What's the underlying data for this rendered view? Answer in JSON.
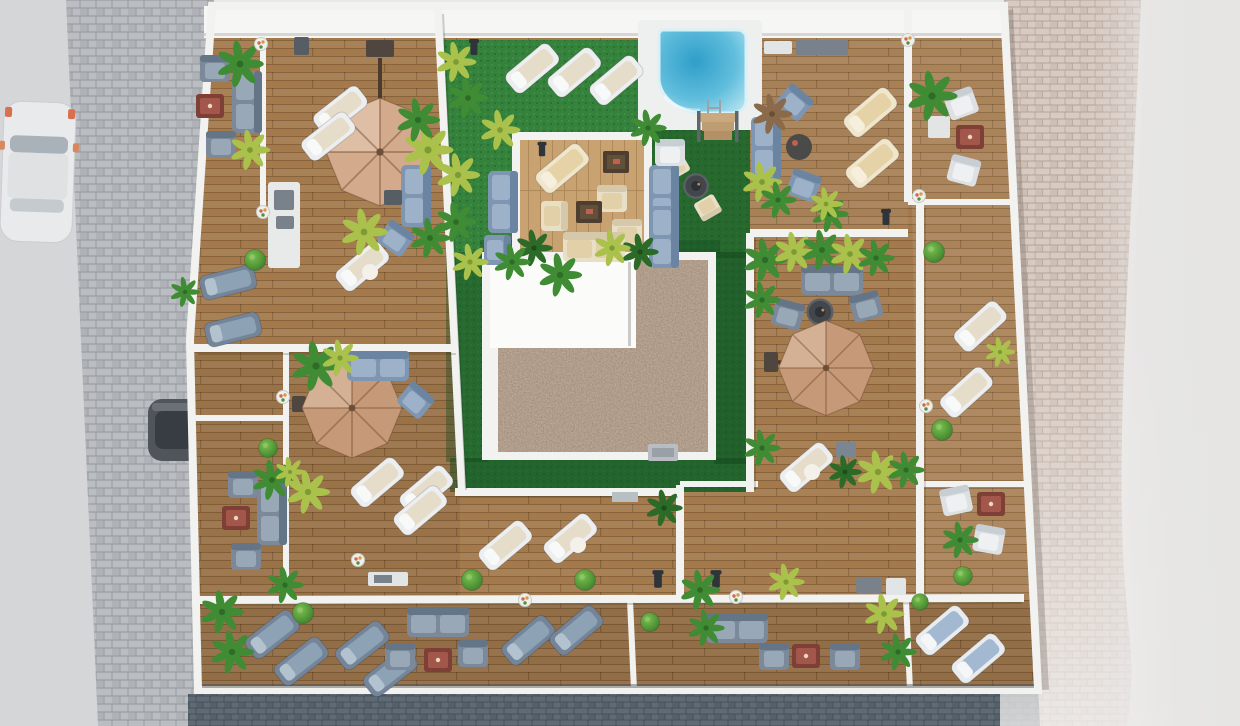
{
  "scene": {
    "title": "Aerial 3D architectural render of a rooftop terrace level",
    "type": "architectural-visualization",
    "view": "top-down aerial",
    "no_visible_text": true,
    "areas": [
      {
        "name": "street-west",
        "features": [
          "light asphalt road",
          "parked white car",
          "cobblestone sidewalk strip",
          "parked dark car half hidden by building"
        ]
      },
      {
        "name": "pavement-east",
        "features": [
          "pink cobblestone pavement fading to plain concrete at right edge",
          "curved white curb at south-east corner"
        ]
      },
      {
        "name": "street-south",
        "features": [
          "dark blue-grey cobblestone roadway"
        ]
      },
      {
        "name": "communal-courtyard",
        "features": [
          "artificial lawn",
          "swimming pool with curved corner, ladder and timber steps",
          "raised timber sun platform with beige lounge furniture",
          "three white sun loungers",
          "round fire table with chairs",
          "blue-grey outdoor sofas",
          "tropical planting"
        ]
      },
      {
        "name": "central-roof-core",
        "features": [
          "white flat roof",
          "L-shaped brown gravel roof",
          "rooftop AC unit",
          "cast shadow on lawn"
        ]
      },
      {
        "name": "private-terraces",
        "features": [
          "timber decking",
          "three tan cantilever parasols",
          "white and grey sun loungers",
          "grey outdoor sofa sets with terracotta coffee tables",
          "outdoor kitchen counters",
          "white parapet dividing walls",
          "topiary balls, palms and yellow-green shrubs",
          "planters with flowers",
          "black bollard lights"
        ]
      }
    ],
    "counts": {
      "parasols": 3,
      "swimming_pools": 1,
      "cars": 2,
      "fire_tables": 2
    }
  },
  "colors": {
    "bg": "#e8e8e7",
    "road": "#d5d6d8",
    "plain_right": "#e6e5e4",
    "cobble_l": "#babdc1",
    "cobble_l2": "#afb3b7",
    "cobble_l_joint": "#9fa3a8",
    "cobble_pink": "#d7cac2",
    "cobble_pink2": "#cebfb5",
    "cobble_pink_joint": "#bcab9f",
    "cobble_dark": "#5f6a74",
    "cobble_dark2": "#55606a",
    "cobble_dark_joint": "#47525c",
    "white_band": "#f6f6f4",
    "wall": "#f2f3f1",
    "wood": "#a47a4d",
    "wood_line": "rgba(74,46,20,0.32)",
    "platform": "#c9a271",
    "platform_line": "rgba(120,84,44,0.33)",
    "grass": "#35823c",
    "grass_light": "#4d9b4b",
    "grass_dark": "#20592b",
    "shadow_green": "#12451d",
    "pool_deep": "#2f9ec9",
    "pool_mid": "#62bedd",
    "pool_light": "#aadfee",
    "pool_deck": "#edf0ef",
    "gravel": "#8f7765",
    "roof_white": "#fbfbfa",
    "umbrella": "#c69a79",
    "umbrella_light": "#d3ab8c",
    "lounger_white": "#eceef0",
    "lounger_cushion": "#e5dcc9",
    "table_red": "#a3574a",
    "table_red_dark": "#7e4036",
    "firepit": "#43474c",
    "car_white": "#e9eaec",
    "car_white_glass": "#a9b2b9",
    "car_dark": "#50555b",
    "car_dark_glass": "#383d43",
    "counter": "#e8eae9",
    "counter_top": "#79828a",
    "ac_unit": "#b7bdc2",
    "lamp": "#2f343a",
    "metal": "#9aa3aa"
  }
}
